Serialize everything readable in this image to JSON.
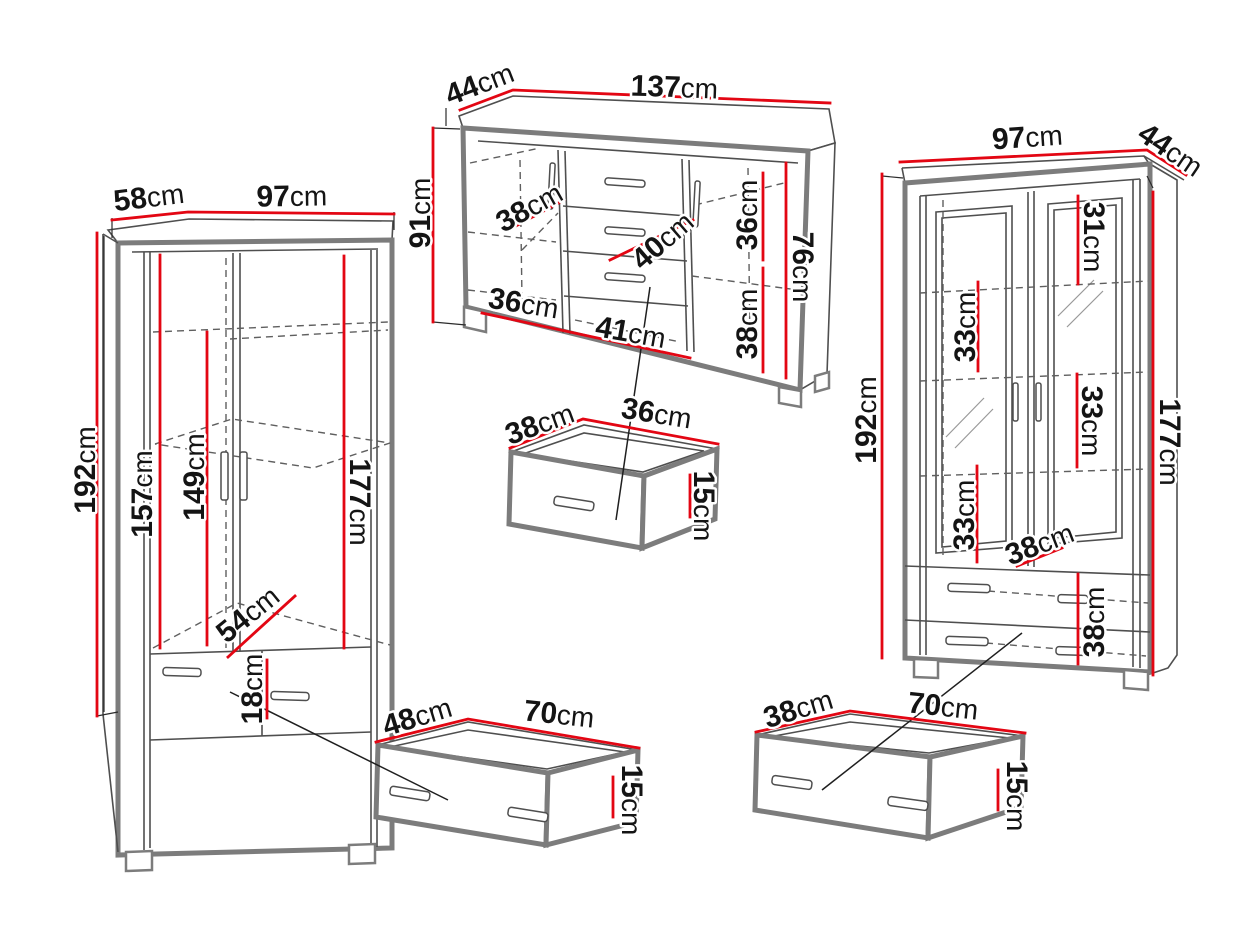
{
  "accent_color": "#e30613",
  "outline_color": "#7c7c7c",
  "detail_color": "#4f4f4f",
  "text_color": "#141414",
  "background_color": "#ffffff",
  "unit": "cm",
  "pieces": {
    "wardrobe": {
      "dims": {
        "depth": {
          "num": "58",
          "unit": "cm"
        },
        "width": {
          "num": "97",
          "unit": "cm"
        },
        "height": {
          "num": "192",
          "unit": "cm"
        },
        "interior_left_height": {
          "num": "157",
          "unit": "cm"
        },
        "interior_rail_height": {
          "num": "149",
          "unit": "cm"
        },
        "interior_right_height": {
          "num": "177",
          "unit": "cm"
        },
        "interior_diagonal_width": {
          "num": "54",
          "unit": "cm"
        },
        "drawer_front_height": {
          "num": "18",
          "unit": "cm"
        }
      }
    },
    "sideboard": {
      "dims": {
        "depth": {
          "num": "44",
          "unit": "cm"
        },
        "width": {
          "num": "137",
          "unit": "cm"
        },
        "height": {
          "num": "91",
          "unit": "cm"
        },
        "left_shelf_diagonal": {
          "num": "38",
          "unit": "cm"
        },
        "center_shelf_diagonal": {
          "num": "40",
          "unit": "cm"
        },
        "right_upper_height": {
          "num": "36",
          "unit": "cm"
        },
        "right_lower_height": {
          "num": "38",
          "unit": "cm"
        },
        "right_total_height": {
          "num": "76",
          "unit": "cm"
        },
        "bottom_left_width": {
          "num": "36",
          "unit": "cm"
        },
        "bottom_center_width": {
          "num": "41",
          "unit": "cm"
        }
      }
    },
    "sideboard_drawer": {
      "dims": {
        "depth": {
          "num": "38",
          "unit": "cm"
        },
        "width": {
          "num": "36",
          "unit": "cm"
        },
        "height": {
          "num": "15",
          "unit": "cm"
        }
      }
    },
    "display_cabinet": {
      "dims": {
        "width": {
          "num": "97",
          "unit": "cm"
        },
        "depth": {
          "num": "44",
          "unit": "cm"
        },
        "height": {
          "num": "192",
          "unit": "cm"
        },
        "interior_right_height": {
          "num": "177",
          "unit": "cm"
        },
        "top_section_height": {
          "num": "31",
          "unit": "cm"
        },
        "upper_left_section_height": {
          "num": "33",
          "unit": "cm"
        },
        "middle_right_section_height": {
          "num": "33",
          "unit": "cm"
        },
        "lower_left_section_height": {
          "num": "33",
          "unit": "cm"
        },
        "shelf_diagonal": {
          "num": "38",
          "unit": "cm"
        },
        "drawer_section_height": {
          "num": "38",
          "unit": "cm"
        }
      }
    },
    "wardrobe_drawer": {
      "dims": {
        "depth": {
          "num": "48",
          "unit": "cm"
        },
        "width": {
          "num": "70",
          "unit": "cm"
        },
        "height": {
          "num": "15",
          "unit": "cm"
        }
      }
    },
    "cabinet_drawer": {
      "dims": {
        "depth": {
          "num": "38",
          "unit": "cm"
        },
        "width": {
          "num": "70",
          "unit": "cm"
        },
        "height": {
          "num": "15",
          "unit": "cm"
        }
      }
    }
  }
}
